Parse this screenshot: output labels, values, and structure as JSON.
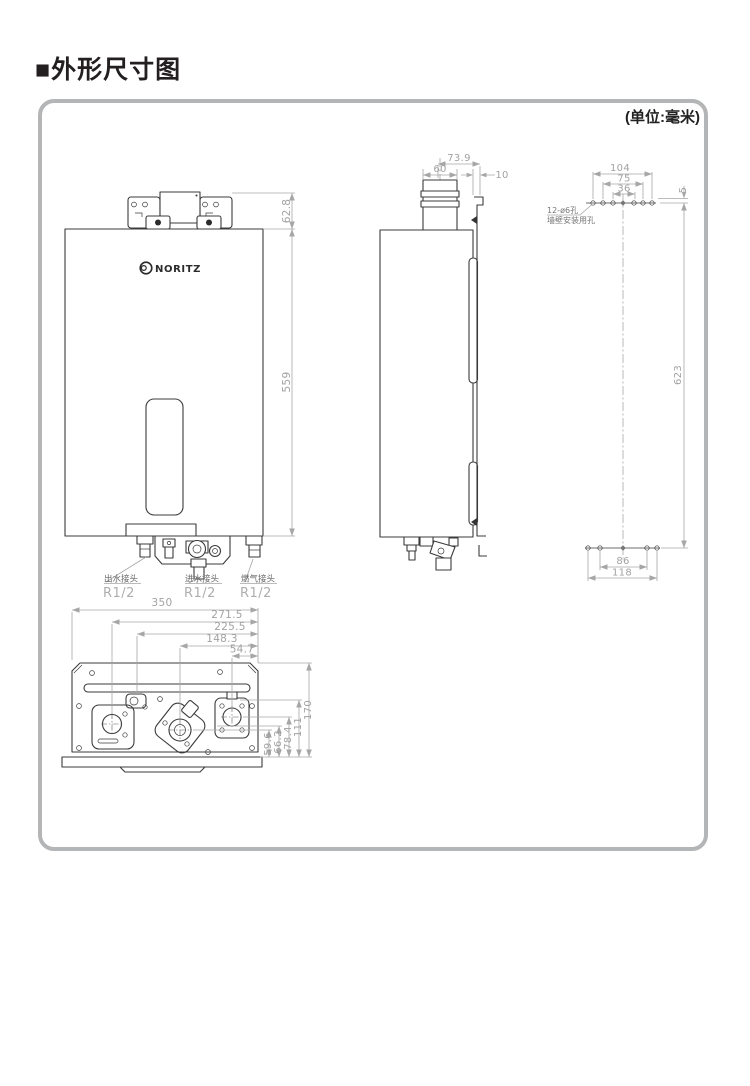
{
  "page": {
    "title": "■外形尺寸图",
    "unit_note": "(单位:毫米)"
  },
  "logo": {
    "brand": "NORITZ"
  },
  "front_view": {
    "dims": {
      "bracket_height": "62.8",
      "body_height": "559"
    },
    "connections": [
      {
        "label": "出水接头",
        "size": "R1/2"
      },
      {
        "label": "进水接头",
        "size": "R1/2"
      },
      {
        "label": "燃气接头",
        "size": "R1/2"
      }
    ]
  },
  "side_view": {
    "dims": {
      "flue_offset": "73.9",
      "flue_width": "60",
      "wall_gap": "10"
    }
  },
  "rear_view": {
    "dims": {
      "top_outer": "104",
      "top_mid": "75",
      "top_inner": "36",
      "edge_offset": "5",
      "mount_height": "623",
      "bottom_inner": "86",
      "bottom_outer": "118"
    },
    "note": {
      "line1": "12-ø6孔",
      "line2": "墙壁安装用孔"
    }
  },
  "bottom_view": {
    "dims": {
      "width": "350",
      "pos_1": "271.5",
      "pos_2": "225.5",
      "pos_3": "148.3",
      "pos_4": "54.7",
      "depth_1": "59.6",
      "depth_2": "66.2",
      "depth_3": "78.4",
      "depth_4": "111",
      "depth": "170"
    }
  },
  "colors": {
    "line": "#3b3b3b",
    "dim": "#a2a2a2",
    "panel_border": "#b3b5b6"
  }
}
